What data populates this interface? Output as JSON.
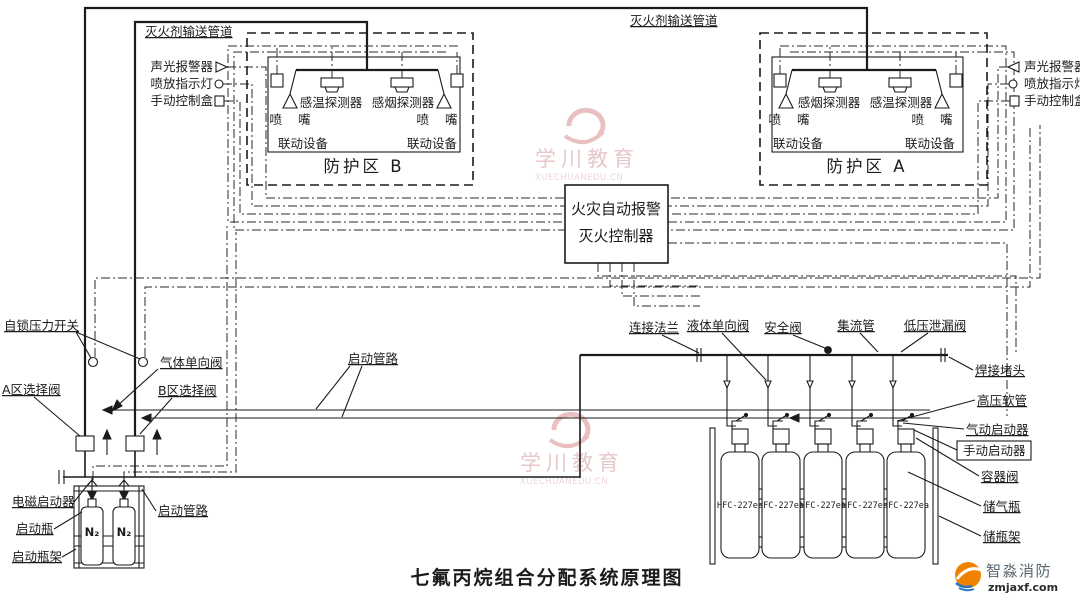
{
  "title": "七氟丙烷组合分配系统原理图",
  "watermark": {
    "name": "学川教育",
    "site": "XUECHUANEDU.CN"
  },
  "brand": {
    "name": "智淼消防",
    "site": "zmjaxf.com",
    "orange": "#ef8200",
    "blue": "#2879c0"
  },
  "pipes": {
    "top_left": "灭火剂输送管道",
    "top_right": "灭火剂输送管道"
  },
  "zone_b": {
    "name": "防护区 B",
    "det1": "感温探测器",
    "det2": "感烟探测器",
    "nozzle_l": "喷 嘴",
    "nozzle_r": "喷 嘴",
    "link_l": "联动设备",
    "link_r": "联动设备"
  },
  "zone_a": {
    "name": "防护区 A",
    "det1": "感烟探测器",
    "det2": "感温探测器",
    "nozzle_l": "喷 嘴",
    "nozzle_r": "喷 嘴",
    "link_l": "联动设备",
    "link_r": "联动设备"
  },
  "devices_left": {
    "alarm": "声光报警器",
    "lamp": "喷放指示灯",
    "manual": "手动控制盒"
  },
  "devices_right": {
    "alarm": "声光报警器",
    "lamp": "喷放指示灯",
    "manual": "手动控制盒"
  },
  "controller": {
    "line1": "火灾自动报警",
    "line2": "灭火控制器"
  },
  "left_station": {
    "pressure_switch": "自锁压力开关",
    "gas_check": "气体单向阀",
    "selector_a": "A区选择阀",
    "selector_b": "B区选择阀",
    "solenoid": "电磁启动器",
    "starter_bottle": "启动瓶",
    "starter_rack": "启动瓶架",
    "starter_pipe": "启动管路",
    "n2": "N₂"
  },
  "center_labels": {
    "starter_pipe": "启动管路"
  },
  "manifold": {
    "flange": "连接法兰",
    "liquid_check": "液体单向阀",
    "safety": "安全阀",
    "collector": "集流管",
    "leak": "低压泄漏阀"
  },
  "storage": {
    "plug": "焊接堵头",
    "hose": "高压软管",
    "pneumatic": "气动启动器",
    "manual": "手动启动器",
    "container_valve": "容器阀",
    "bottle": "储气瓶",
    "rack": "储瓶架"
  },
  "cylinders": [
    "HFC-227ea",
    "HFC-227ea",
    "HFC-227ea",
    "HFC-227ea",
    "HFC-227ea"
  ]
}
